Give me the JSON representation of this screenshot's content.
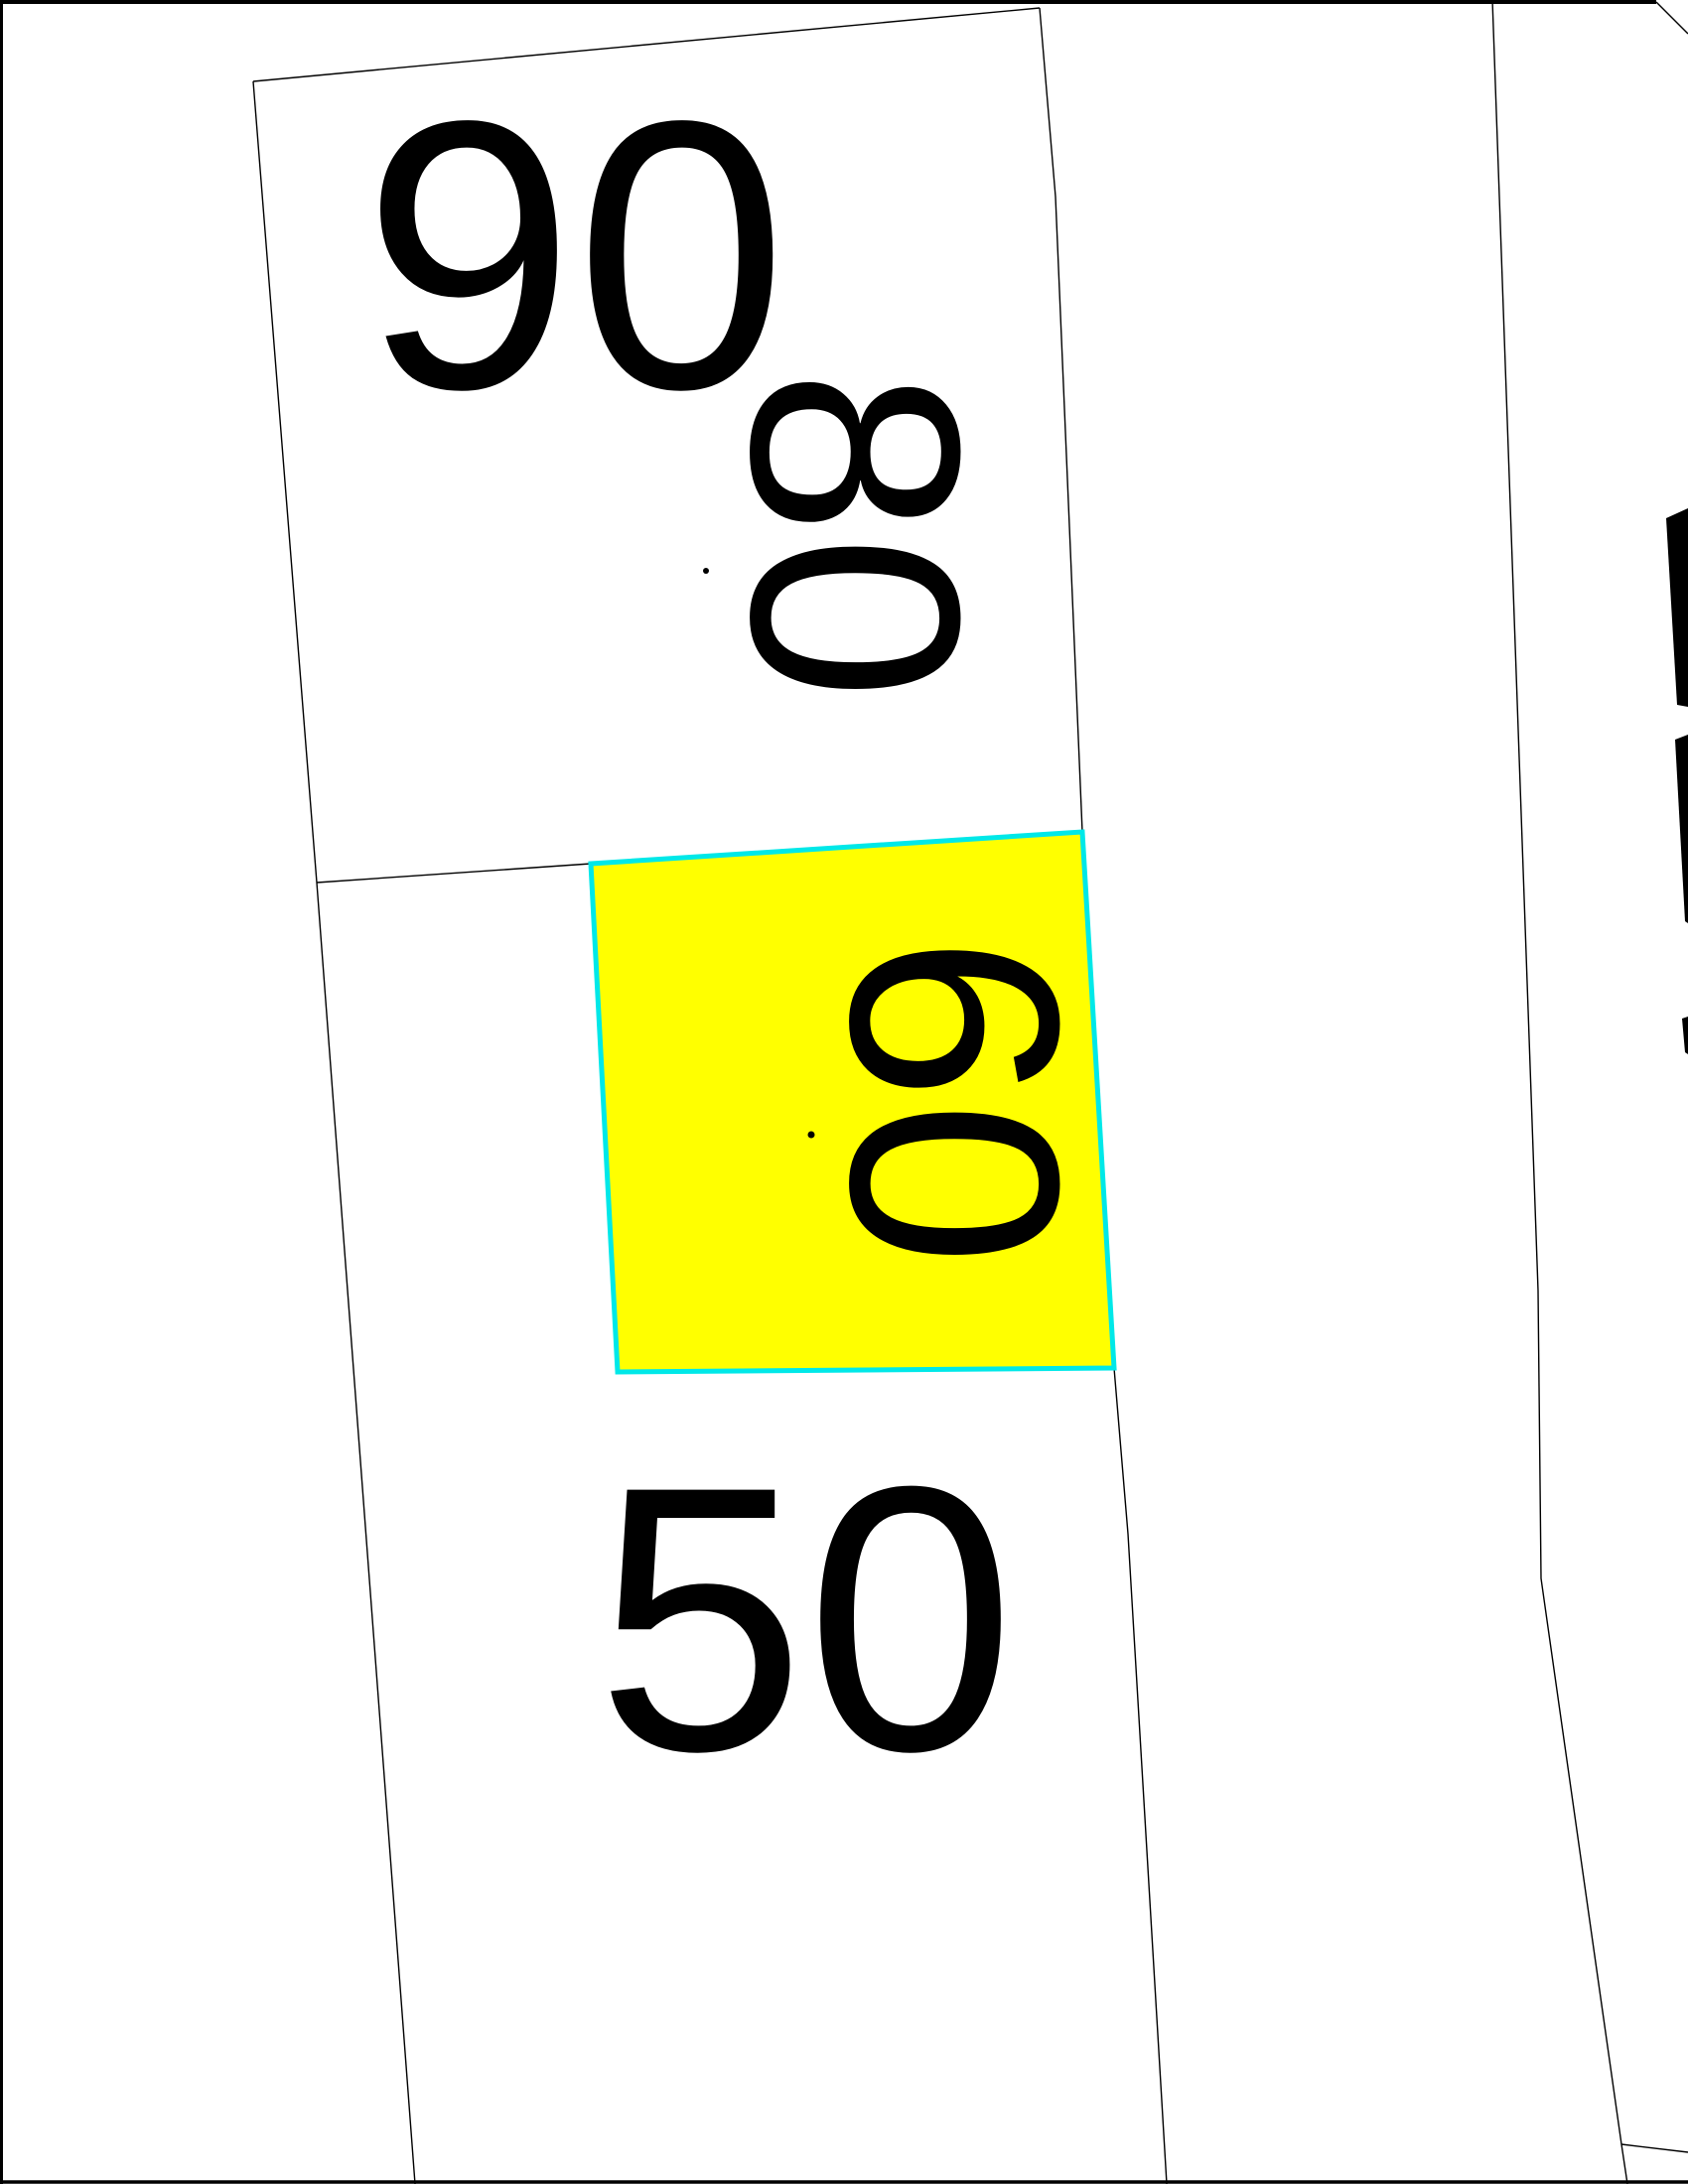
{
  "app": {
    "type": "cadastral-parcel-map-viewer",
    "description": "Cadastral map extract showing parcel boundaries; parcel 60 is selected/highlighted in yellow with a cyan outline"
  },
  "map": {
    "background": "#ffffff",
    "colors": {
      "boundary": "#000000",
      "border": "#000000",
      "highlight_fill": "#ffff00",
      "highlight_stroke": "#00e8e8",
      "label": "#000000"
    },
    "selected_parcel": "60",
    "parcels": [
      {
        "id": "90",
        "label": "90",
        "label_orientation": "horizontal",
        "highlighted": false,
        "has_point_marker": true
      },
      {
        "id": "80",
        "label": "80",
        "label_orientation": "rotated-90-cw",
        "highlighted": false,
        "has_point_marker": false
      },
      {
        "id": "60",
        "label": "60",
        "label_orientation": "rotated-90-cw",
        "highlighted": true,
        "has_point_marker": true
      },
      {
        "id": "50",
        "label": "50",
        "label_orientation": "horizontal",
        "highlighted": false,
        "has_point_marker": false
      }
    ],
    "point_markers": [
      {
        "inside_parcel": "90"
      },
      {
        "inside_parcel": "60"
      }
    ],
    "clipped_neighbor_label_fragments_right_edge": 3
  }
}
